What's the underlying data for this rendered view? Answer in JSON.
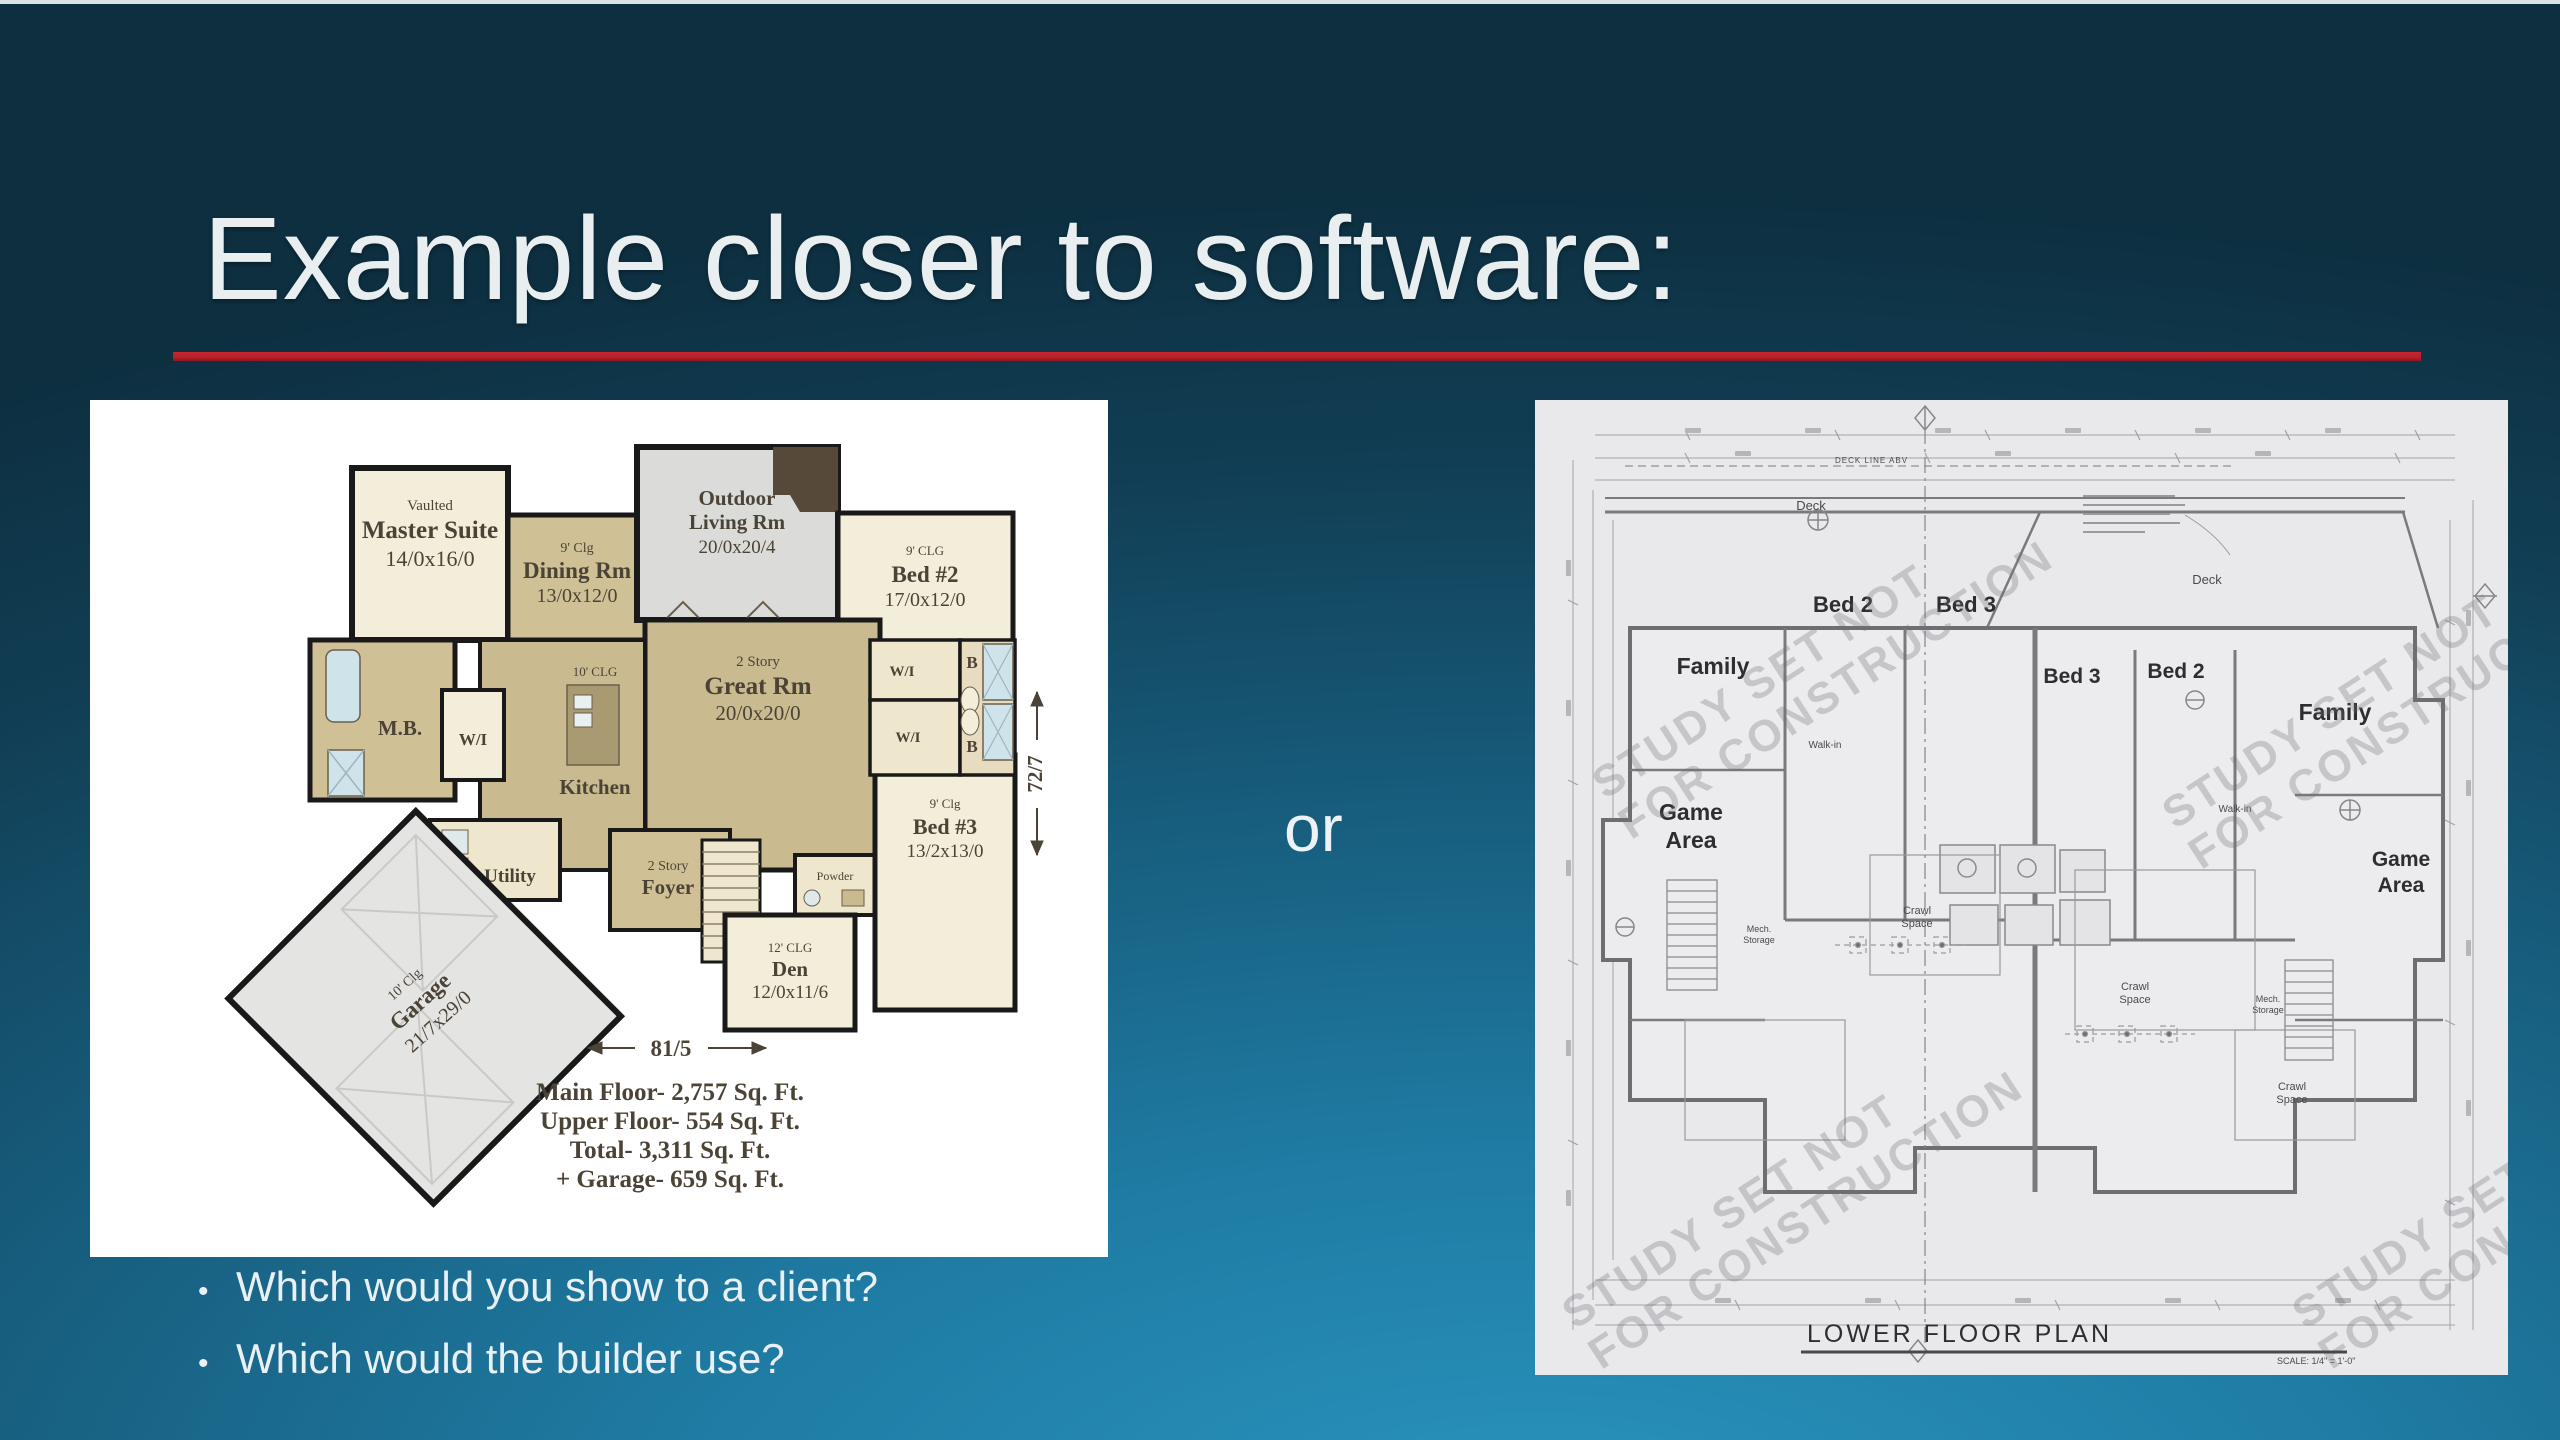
{
  "slide": {
    "title": "Example closer to software:",
    "or_label": "or",
    "bullets": [
      "Which would you show to a client?",
      "Which would the builder use?"
    ],
    "colors": {
      "background_top": "#0d2f40",
      "background_bottom": "#2a96c0",
      "accent_rule": "#b5222b",
      "title_text": "#e9eef1"
    }
  },
  "left_plan": {
    "rooms": [
      {
        "name": "master-suite",
        "lines": [
          "Vaulted",
          "Master Suite",
          "14/0x16/0"
        ]
      },
      {
        "name": "dining-room",
        "lines": [
          "9' Clg",
          "Dining Rm",
          "13/0x12/0"
        ]
      },
      {
        "name": "outdoor-living",
        "lines": [
          "Outdoor",
          "Living Rm",
          "20/0x20/4"
        ]
      },
      {
        "name": "bed-2",
        "lines": [
          "9' CLG",
          "Bed #2",
          "17/0x12/0"
        ]
      },
      {
        "name": "great-room",
        "lines": [
          "2 Story",
          "Great Rm",
          "20/0x20/0"
        ]
      },
      {
        "name": "kitchen",
        "lines": [
          "10' CLG",
          "Kitchen"
        ]
      },
      {
        "name": "master-bath",
        "lines": [
          "M.B."
        ]
      },
      {
        "name": "master-closet",
        "lines": [
          "W/I"
        ]
      },
      {
        "name": "utility",
        "lines": [
          "Utility"
        ]
      },
      {
        "name": "foyer",
        "lines": [
          "2 Story",
          "Foyer"
        ]
      },
      {
        "name": "powder",
        "lines": [
          "Powder"
        ]
      },
      {
        "name": "den",
        "lines": [
          "12' CLG",
          "Den",
          "12/0x11/6"
        ]
      },
      {
        "name": "bed-3",
        "lines": [
          "9' Clg",
          "Bed #3",
          "13/2x13/0"
        ]
      },
      {
        "name": "closet-1",
        "lines": [
          "W/I"
        ]
      },
      {
        "name": "closet-2",
        "lines": [
          "W/I"
        ]
      },
      {
        "name": "bath-1",
        "lines": [
          "B"
        ]
      },
      {
        "name": "bath-2",
        "lines": [
          "B"
        ]
      },
      {
        "name": "garage",
        "lines": [
          "10' Clg",
          "Garage",
          "21/7x29/0"
        ]
      }
    ],
    "dimensions": {
      "width": "81/5",
      "height": "72/7"
    },
    "area_summary": [
      "Main Floor- 2,757 Sq. Ft.",
      "Upper Floor- 554 Sq. Ft.",
      "Total- 3,311 Sq. Ft.",
      "+ Garage- 659 Sq. Ft."
    ]
  },
  "right_plan": {
    "caption": "LOWER FLOOR PLAN",
    "scale_note": "SCALE: 1/4\" = 1'-0\"",
    "deck_note": "DECK LINE ABV",
    "watermark": {
      "line1": "STUDY SET NOT",
      "line2": "FOR CONSTRUCTION"
    },
    "labels": {
      "deck_left": "Deck",
      "deck_right": "Deck",
      "bed2_left": "Bed 2",
      "bed3_left": "Bed 3",
      "family_left": "Family",
      "game_left_1": "Game",
      "game_left_2": "Area",
      "bed3_right": "Bed 3",
      "bed2_right": "Bed 2",
      "family_right": "Family",
      "game_right_1": "Game",
      "game_right_2": "Area",
      "walkin_left": "Walk-in",
      "walkin_right": "Walk-in",
      "crawl_1_1": "Crawl",
      "crawl_1_2": "Space",
      "crawl_2_1": "Crawl",
      "crawl_2_2": "Space",
      "crawl_3_1": "Crawl",
      "crawl_3_2": "Space",
      "mech_left_1": "Mech.",
      "mech_left_2": "Storage",
      "mech_right_1": "Mech.",
      "mech_right_2": "Storage"
    }
  }
}
